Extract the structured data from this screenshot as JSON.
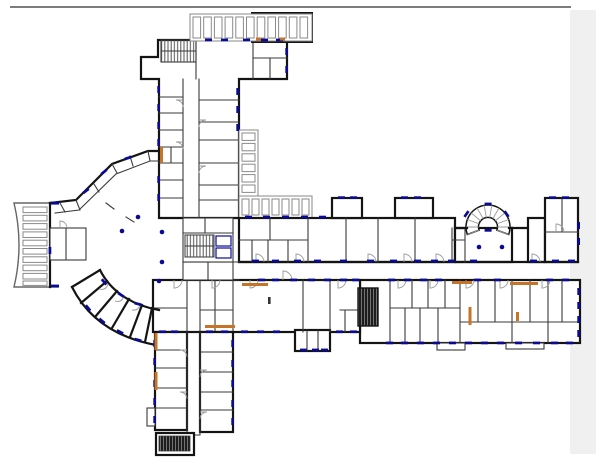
{
  "app": {
    "type": "cad-floor-plan-viewer",
    "background": "#ffffff"
  },
  "chrome": {
    "top_rule_color": "#7c7c7c",
    "scrollbar_track_color": "#f0f0f0"
  },
  "colors": {
    "wall": "#141414",
    "wall2": "#3a3a3a",
    "gray": "#8a8a8a",
    "navy": "#0a0a96",
    "orange": "#c87428",
    "rule": "#7c7c7c",
    "panel": "#f0f0f0",
    "door": "#9a9a9a"
  },
  "plan": {
    "features": [
      "fan-shaped-atrium",
      "west-entrance-steps",
      "north-wing",
      "east-wing-double-loaded-corridor",
      "south-wing",
      "semicircular-stair",
      "straight-stair-cores",
      "terrace-partitions",
      "window-markers-navy",
      "column-dots-navy",
      "orange-wall-markers",
      "door-swing-arcs"
    ],
    "column_dots_px": [
      [
        122,
        231
      ],
      [
        138,
        217
      ],
      [
        162,
        232
      ],
      [
        162,
        262
      ],
      [
        159,
        281
      ],
      [
        479,
        247
      ],
      [
        502,
        247
      ]
    ],
    "stair_cores_px": [
      [
        161,
        40
      ],
      [
        185,
        235
      ],
      [
        358,
        288
      ],
      [
        158,
        435
      ],
      [
        488,
        227
      ]
    ]
  }
}
